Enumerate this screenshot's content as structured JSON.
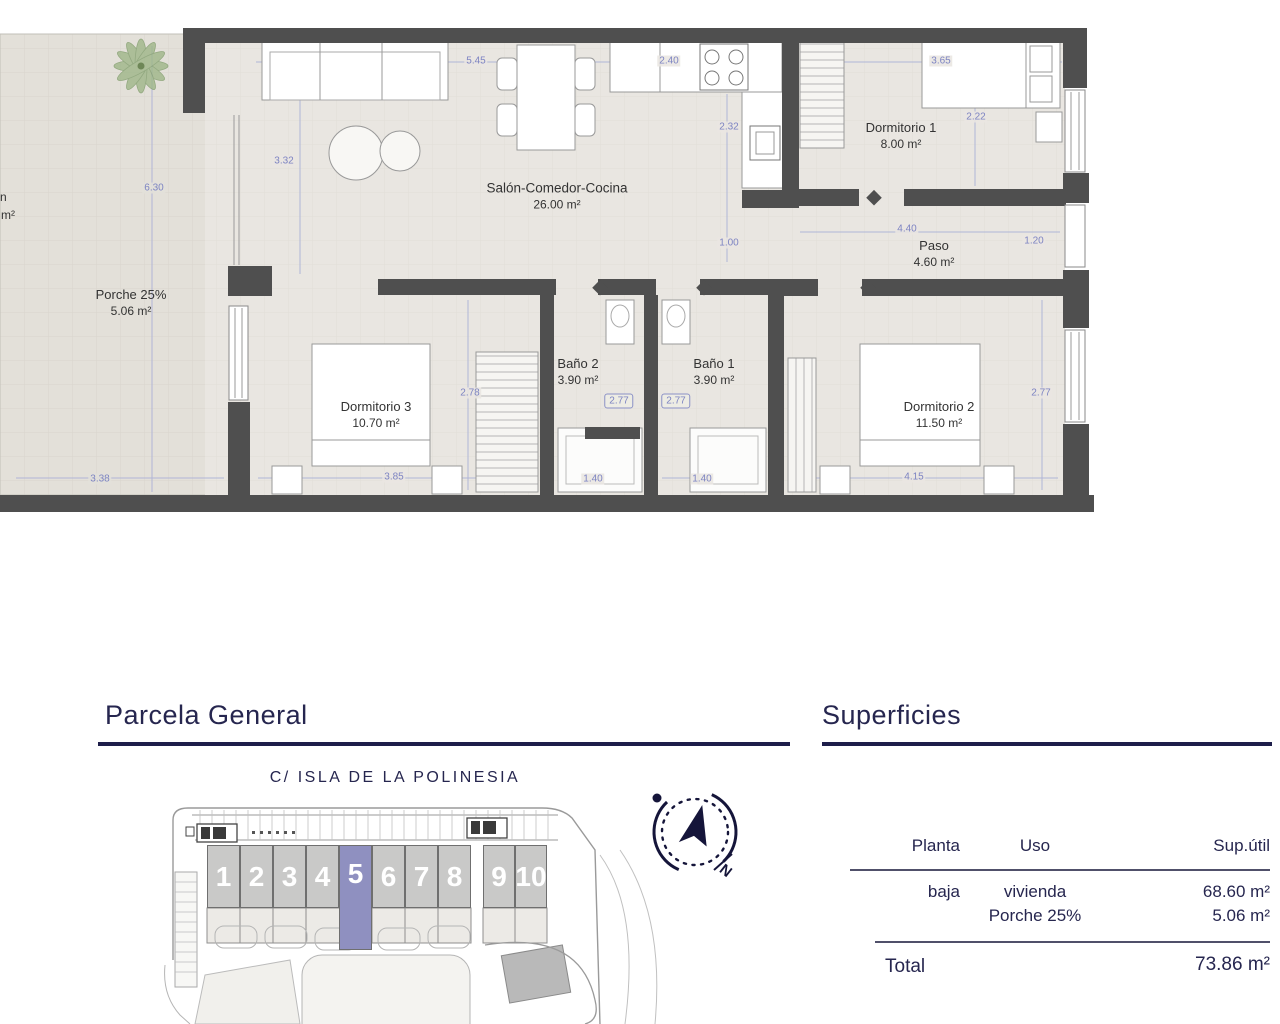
{
  "floor_plan": {
    "rooms": {
      "salon": {
        "name": "Salón-Comedor-Cocina",
        "area": "26.00 m²"
      },
      "dormitorio1": {
        "name": "Dormitorio 1",
        "area": "8.00 m²"
      },
      "paso": {
        "name": "Paso",
        "area": "4.60 m²"
      },
      "bano2": {
        "name": "Baño 2",
        "area": "3.90 m²"
      },
      "bano1": {
        "name": "Baño 1",
        "area": "3.90 m²"
      },
      "dormitorio3": {
        "name": "Dormitorio 3",
        "area": "10.70 m²"
      },
      "dormitorio2": {
        "name": "Dormitorio 2",
        "area": "11.50 m²"
      },
      "porche": {
        "name": "Porche 25%",
        "area": "5.06 m²"
      }
    },
    "left_edge_partial": {
      "line1": "n",
      "line2": "m²"
    },
    "dims": {
      "salon_top": "5.45",
      "cocina_top": "2.40",
      "dorm1_top": "3.65",
      "salon_left": "3.32",
      "cocina_mid": "2.32",
      "dorm1_side": "2.22",
      "porche_height": "6.30",
      "cocina_low": "1.00",
      "paso_width": "4.40",
      "paso_depth": "1.20",
      "dorm3_side": "2.78",
      "bano2_width": "2.77",
      "bano1_width": "2.77",
      "dorm2_side": "2.77",
      "porche_bottom": "3.38",
      "dorm3_bottom": "3.85",
      "bano2_bottom": "1.40",
      "bano1_bottom": "1.40",
      "dorm2_bottom": "4.15"
    }
  },
  "parcela": {
    "heading": "Parcela General",
    "street": "C/ ISLA DE LA POLINESIA",
    "plots": [
      "1",
      "2",
      "3",
      "4",
      "5",
      "6",
      "7",
      "8",
      "9",
      "10"
    ],
    "highlighted_plot": "5",
    "compass_label": "N"
  },
  "superficies": {
    "heading": "Superficies",
    "columns": [
      "Planta",
      "Uso",
      "Sup.útil"
    ],
    "rows": [
      {
        "planta": "baja",
        "uso": "vivienda",
        "sup": "68.60 m²"
      },
      {
        "planta": "",
        "uso": "Porche 25%",
        "sup": "5.06 m²"
      }
    ],
    "total_label": "Total",
    "total_value": "73.86 m²"
  },
  "colors": {
    "accent_navy": "#26264f",
    "dimension_blue": "#7d84c2",
    "plot_highlight": "#8f90c0",
    "plot_gray": "#c9c9c8",
    "wall_gray": "#4f4f4f",
    "floor_beige": "#e9e6e1"
  }
}
